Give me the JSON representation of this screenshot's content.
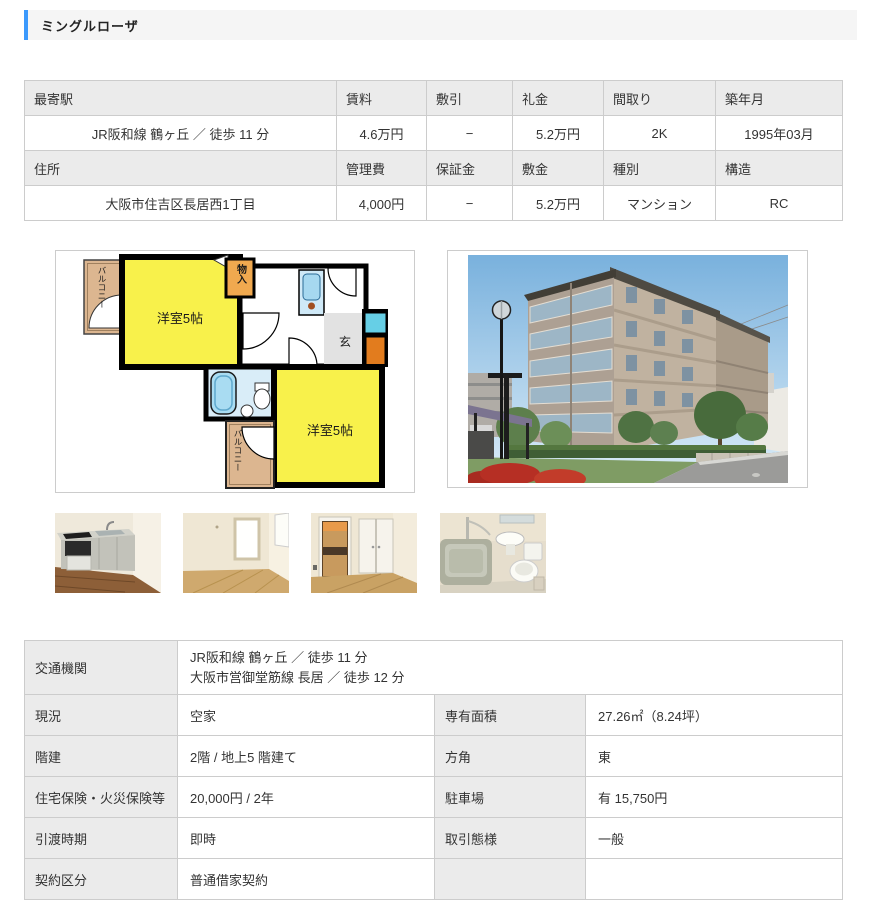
{
  "page": {
    "title": "ミングルローザ"
  },
  "colors": {
    "accent_blue": "#3b99fc",
    "header_cell_bg": "#ebebeb",
    "table_border": "#cccccc",
    "floorplan_room_yellow": "#f8f14b",
    "floorplan_balcony_tan": "#dcb690"
  },
  "summary_table": {
    "header_row_1": [
      "最寄駅",
      "賃料",
      "敷引",
      "礼金",
      "間取り",
      "築年月"
    ],
    "value_row_1": [
      "JR阪和線 鶴ヶ丘 ／ 徒歩 11 分",
      "4.6万円",
      "−",
      "5.2万円",
      "2K",
      "1995年03月"
    ],
    "header_row_2": [
      "住所",
      "管理費",
      "保証金",
      "敷金",
      "種別",
      "構造"
    ],
    "value_row_2": [
      "大阪市住吉区長居西1丁目",
      "4,000円",
      "−",
      "5.2万円",
      "マンション",
      "RC"
    ]
  },
  "floorplan": {
    "room_west_label": "洋室5帖",
    "room_east_label": "洋室5帖",
    "closet_label": "物入",
    "entrance_label": "玄",
    "balcony_top_label": "バルコニー",
    "balcony_bottom_label": "バルコニー"
  },
  "detail_table": {
    "rows": [
      {
        "label": "交通機関",
        "value_line1": "JR阪和線 鶴ヶ丘 ／ 徒歩 11 分",
        "value_line2": "大阪市営御堂筋線 長居 ／ 徒歩 12 分"
      },
      {
        "label1": "現況",
        "value1": "空家",
        "label2": "専有面積",
        "value2": "27.26㎡（8.24坪）"
      },
      {
        "label1": "階建",
        "value1": "2階 / 地上5 階建て",
        "label2": "方角",
        "value2": "東"
      },
      {
        "label1": "住宅保険・火災保険等",
        "value1": "20,000円 / 2年",
        "label2": "駐車場",
        "value2": "有 15,750円"
      },
      {
        "label1": "引渡時期",
        "value1": "即時",
        "label2": "取引態様",
        "value2": "一般"
      },
      {
        "label1": "契約区分",
        "value1": "普通借家契約",
        "label2": "",
        "value2": ""
      }
    ]
  }
}
